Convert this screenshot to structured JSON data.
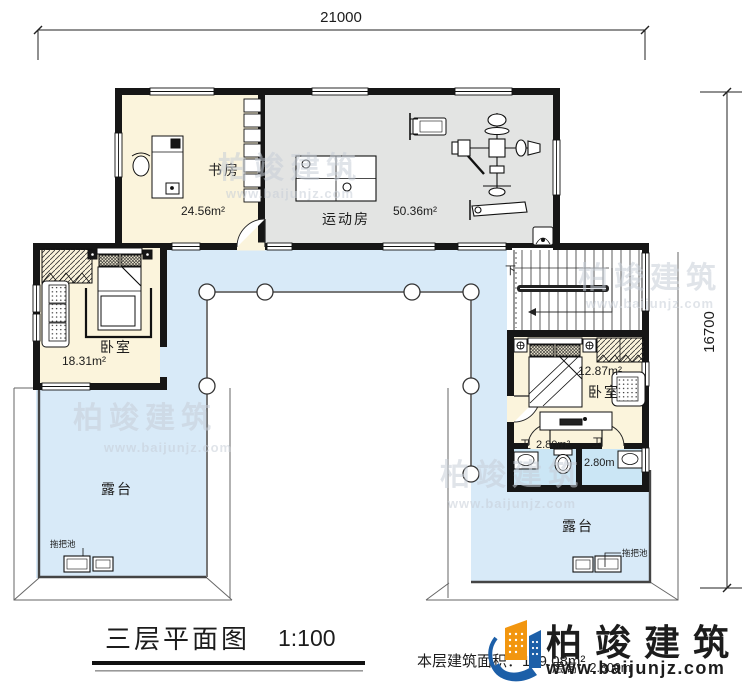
{
  "dimensions": {
    "width_label": "21000",
    "height_label": "16700"
  },
  "rooms": {
    "study": {
      "name": "书房",
      "area": "24.56m²"
    },
    "gym": {
      "name": "运动房",
      "area": "50.36m²"
    },
    "bedroom_left": {
      "name": "卧室",
      "area": "18.31m²"
    },
    "bedroom_right": {
      "name": "卧室",
      "area": "12.87m²"
    },
    "bath_left": {
      "name": "卫",
      "area": "2.80m²"
    },
    "bath_right": {
      "name": "卫",
      "area": "2.80m"
    },
    "terrace_left": {
      "name": "露台"
    },
    "terrace_right": {
      "name": "露台"
    },
    "stairs": {
      "down_label": "下"
    },
    "mop_sink": {
      "label": "拖把池"
    }
  },
  "title_block": {
    "title": "三层平面图",
    "scale": "1:100",
    "area_note": "本层建筑面积：139.08m²",
    "floor_height_note": "层高：2.800m"
  },
  "branding": {
    "logo_text": "柏竣建筑",
    "website": "www.baijunjz.com"
  },
  "watermark": {
    "logo_text": "柏竣建筑",
    "website": "www.baijunjz.com"
  },
  "palette": {
    "room_cream": "#FBF4DC",
    "gym_gray": "#E3E4E3",
    "terrace_blue": "#D8EAF8",
    "bath_blue": "#CBE6F5",
    "wall_black": "#161616",
    "logo_orange": "#F2960F",
    "logo_blue": "#1C5FA8",
    "watermark_gray": "#C7CED8"
  }
}
